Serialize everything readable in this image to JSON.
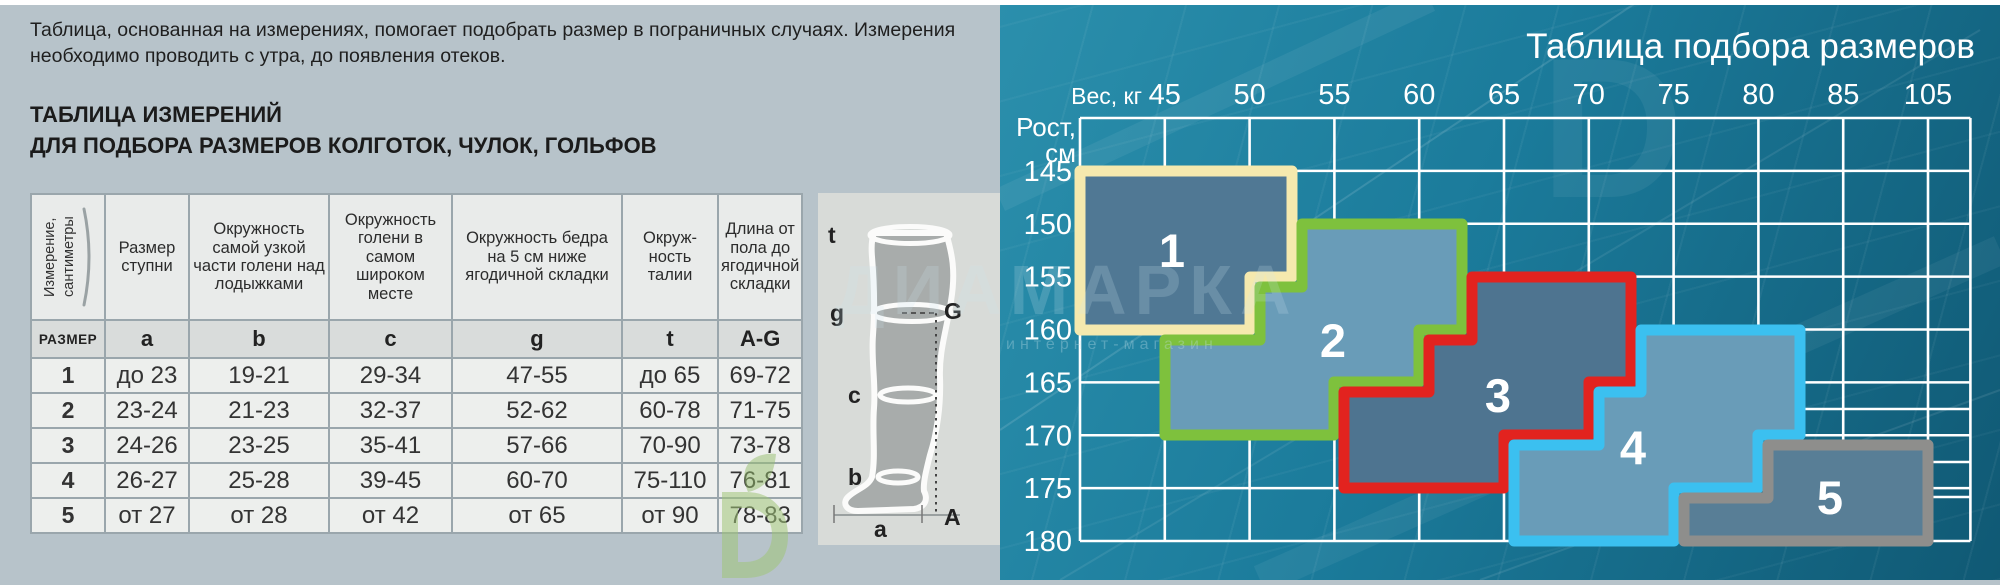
{
  "page": {
    "top_strip_color": "#ffffff",
    "left_bg": "#b7c3ca"
  },
  "watermark": {
    "brand": "ДИАМАРКА",
    "tagline": "интернет-магазин",
    "big_letter": "D"
  },
  "left_panel": {
    "intro": "Таблица, основанная на измерениях, помогает подобрать размер в пограничных случаях. Измерения необходимо проводить с утра, до появления отеков.",
    "heading_line1": "ТАБЛИЦА ИЗМЕРЕНИЙ",
    "heading_line2": "ДЛЯ ПОДБОРА РАЗМЕРОВ КОЛГОТОК, ЧУЛОК, ГОЛЬФОВ",
    "table": {
      "rotated_header": "Измерение, сантиметры",
      "col_headers": [
        "Размер ступни",
        "Окружность самой узкой части голени над лодыжками",
        "Окружность голени в самом широком месте",
        "Окружность бедра на 5 см ниже ягодичной складки",
        "Окруж-ность талии",
        "Длина от пола до ягодичной складки"
      ],
      "size_row": [
        "РАЗМЕР",
        "a",
        "b",
        "c",
        "g",
        "t",
        "A-G"
      ],
      "rows": [
        [
          "1",
          "до 23",
          "19-21",
          "29-34",
          "47-55",
          "до 65",
          "69-72"
        ],
        [
          "2",
          "23-24",
          "21-23",
          "32-37",
          "52-62",
          "60-78",
          "71-75"
        ],
        [
          "3",
          "24-26",
          "23-25",
          "35-41",
          "57-66",
          "70-90",
          "73-78"
        ],
        [
          "4",
          "26-27",
          "25-28",
          "39-45",
          "60-70",
          "75-110",
          "76-81"
        ],
        [
          "5",
          "от 27",
          "от 28",
          "от 42",
          "от 65",
          "от 90",
          "78-83"
        ]
      ]
    },
    "diagram": {
      "t": "t",
      "g": "g",
      "c": "c",
      "b": "b",
      "a": "a",
      "G": "G",
      "A": "A"
    }
  },
  "right_panel": {
    "title": "Таблица подбора размеров",
    "weight_axis_label": "Вес, кг",
    "height_axis_label_line1": "Рост,",
    "height_axis_label_line2": "см",
    "weight_ticks": [
      "45",
      "50",
      "55",
      "60",
      "65",
      "70",
      "75",
      "80",
      "85",
      "105"
    ],
    "height_ticks": [
      "145",
      "150",
      "155",
      "160",
      "165",
      "170",
      "175",
      "180"
    ],
    "grid": {
      "x0": 80,
      "col_w": 84.8,
      "cols": 10,
      "right_x": 970.4,
      "y0": 118,
      "row_h": 52.875,
      "rows": 8,
      "line_color": "#ffffff",
      "line_w": 2.6,
      "sublines": [
        [
          800,
          409,
          970.4,
          409
        ],
        [
          928,
          462,
          970.4,
          462
        ],
        [
          930,
          497,
          970.4,
          497
        ]
      ]
    },
    "streaks": [
      [
        0,
        430,
        640,
        0,
        2,
        0.12
      ],
      [
        60,
        580,
        980,
        30,
        2,
        0.08
      ],
      [
        260,
        580,
        1000,
        250,
        30,
        0.05
      ],
      [
        0,
        200,
        430,
        0,
        24,
        0.06
      ],
      [
        480,
        580,
        1000,
        390,
        2,
        0.09
      ]
    ],
    "region_border_w": 11,
    "regions": [
      {
        "label": "1",
        "fill": "#507894",
        "stroke": "#f5e9ae",
        "points": [
          [
            80,
            171
          ],
          [
            292,
            171
          ],
          [
            292,
            277
          ],
          [
            250,
            277
          ],
          [
            250,
            330
          ],
          [
            80,
            330
          ]
        ],
        "label_xy": [
          172,
          267
        ]
      },
      {
        "label": "2",
        "fill": "#699cb8",
        "stroke": "#7ec13d",
        "points": [
          [
            302,
            224
          ],
          [
            462,
            224
          ],
          [
            462,
            330
          ],
          [
            419,
            330
          ],
          [
            419,
            382
          ],
          [
            334,
            382
          ],
          [
            334,
            435
          ],
          [
            165,
            435
          ],
          [
            165,
            340
          ],
          [
            260,
            340
          ],
          [
            260,
            287
          ],
          [
            302,
            287
          ]
        ],
        "label_xy": [
          333,
          357
        ]
      },
      {
        "label": "3",
        "fill": "#4e7490",
        "stroke": "#e2231f",
        "points": [
          [
            472,
            277
          ],
          [
            631,
            277
          ],
          [
            631,
            382
          ],
          [
            589,
            382
          ],
          [
            589,
            435
          ],
          [
            504,
            435
          ],
          [
            504,
            488
          ],
          [
            344,
            488
          ],
          [
            344,
            392
          ],
          [
            429,
            392
          ],
          [
            429,
            340
          ],
          [
            472,
            340
          ]
        ],
        "label_xy": [
          498,
          412
        ]
      },
      {
        "label": "4",
        "fill": "#699cb8",
        "stroke": "#3bc0f0",
        "points": [
          [
            641,
            330
          ],
          [
            800,
            330
          ],
          [
            800,
            435
          ],
          [
            758,
            435
          ],
          [
            758,
            488
          ],
          [
            674,
            488
          ],
          [
            674,
            541
          ],
          [
            514,
            541
          ],
          [
            514,
            445
          ],
          [
            599,
            445
          ],
          [
            599,
            392
          ],
          [
            641,
            392
          ]
        ],
        "label_xy": [
          633,
          464
        ]
      },
      {
        "label": "5",
        "fill": "#587e96",
        "stroke": "#8e8e8c",
        "points": [
          [
            768,
            445
          ],
          [
            928,
            445
          ],
          [
            928,
            541
          ],
          [
            684,
            541
          ],
          [
            684,
            498
          ],
          [
            768,
            498
          ]
        ],
        "label_xy": [
          830,
          514
        ]
      }
    ],
    "layout": {
      "weight_y": 104,
      "height_x": 72,
      "height_dy": 10,
      "title_xy": [
        975,
        58
      ],
      "weight_cap_xy": [
        142,
        104
      ],
      "height_cap_xy": [
        76,
        136
      ],
      "height_cap_xy2": [
        76,
        162
      ]
    }
  },
  "chart_data": [
    {
      "type": "table",
      "title": "ТАБЛИЦА ИЗМЕРЕНИЙ ДЛЯ ПОДБОРА РАЗМЕРОВ КОЛГОТОК, ЧУЛОК, ГОЛЬФОВ",
      "columns": [
        "РАЗМЕР",
        "a — Размер ступни",
        "b — Окружность самой узкой части голени над лодыжками",
        "c — Окружность голени в самом широком месте",
        "g — Окружность бедра на 5 см ниже ягодичной складки",
        "t — Окружность талии",
        "A-G — Длина от пола до ягодичной складки"
      ],
      "rows": [
        [
          "1",
          "до 23",
          "19-21",
          "29-34",
          "47-55",
          "до 65",
          "69-72"
        ],
        [
          "2",
          "23-24",
          "21-23",
          "32-37",
          "52-62",
          "60-78",
          "71-75"
        ],
        [
          "3",
          "24-26",
          "23-25",
          "35-41",
          "57-66",
          "70-90",
          "73-78"
        ],
        [
          "4",
          "26-27",
          "25-28",
          "39-45",
          "60-70",
          "75-110",
          "76-81"
        ],
        [
          "5",
          "от 27",
          "от 28",
          "от 42",
          "от 65",
          "от 90",
          "78-83"
        ]
      ]
    },
    {
      "type": "area",
      "title": "Таблица подбора размеров",
      "xlabel": "Вес, кг",
      "ylabel": "Рост, см",
      "x_ticks": [
        45,
        50,
        55,
        60,
        65,
        70,
        75,
        80,
        85,
        105
      ],
      "y_ticks": [
        145,
        150,
        155,
        160,
        165,
        170,
        175,
        180
      ],
      "grid": true,
      "regions": [
        {
          "size": 1,
          "polygon_weight_height": [
            [
              40,
              145
            ],
            [
              52.5,
              145
            ],
            [
              52.5,
              155
            ],
            [
              50,
              155
            ],
            [
              50,
              160
            ],
            [
              40,
              160
            ]
          ]
        },
        {
          "size": 2,
          "polygon_weight_height": [
            [
              52.5,
              150
            ],
            [
              62.5,
              150
            ],
            [
              62.5,
              160
            ],
            [
              60,
              160
            ],
            [
              60,
              165
            ],
            [
              55,
              165
            ],
            [
              55,
              170
            ],
            [
              45,
              170
            ],
            [
              45,
              160
            ],
            [
              50,
              160
            ],
            [
              50,
              155
            ],
            [
              52.5,
              155
            ]
          ]
        },
        {
          "size": 3,
          "polygon_weight_height": [
            [
              62.5,
              155
            ],
            [
              72.5,
              155
            ],
            [
              72.5,
              165
            ],
            [
              70,
              165
            ],
            [
              70,
              170
            ],
            [
              65,
              170
            ],
            [
              65,
              175
            ],
            [
              55,
              175
            ],
            [
              55,
              165
            ],
            [
              60,
              165
            ],
            [
              60,
              160
            ],
            [
              62.5,
              160
            ]
          ]
        },
        {
          "size": 4,
          "polygon_weight_height": [
            [
              72.5,
              160
            ],
            [
              82.5,
              160
            ],
            [
              82.5,
              170
            ],
            [
              80,
              170
            ],
            [
              80,
              175
            ],
            [
              75,
              175
            ],
            [
              75,
              180
            ],
            [
              65,
              180
            ],
            [
              65,
              170
            ],
            [
              70,
              170
            ],
            [
              70,
              165
            ],
            [
              72.5,
              165
            ]
          ]
        },
        {
          "size": 5,
          "polygon_weight_height": [
            [
              80,
              170
            ],
            [
              105,
              170
            ],
            [
              105,
              180
            ],
            [
              75,
              180
            ],
            [
              75,
              175
            ],
            [
              80,
              175
            ]
          ]
        }
      ]
    }
  ]
}
